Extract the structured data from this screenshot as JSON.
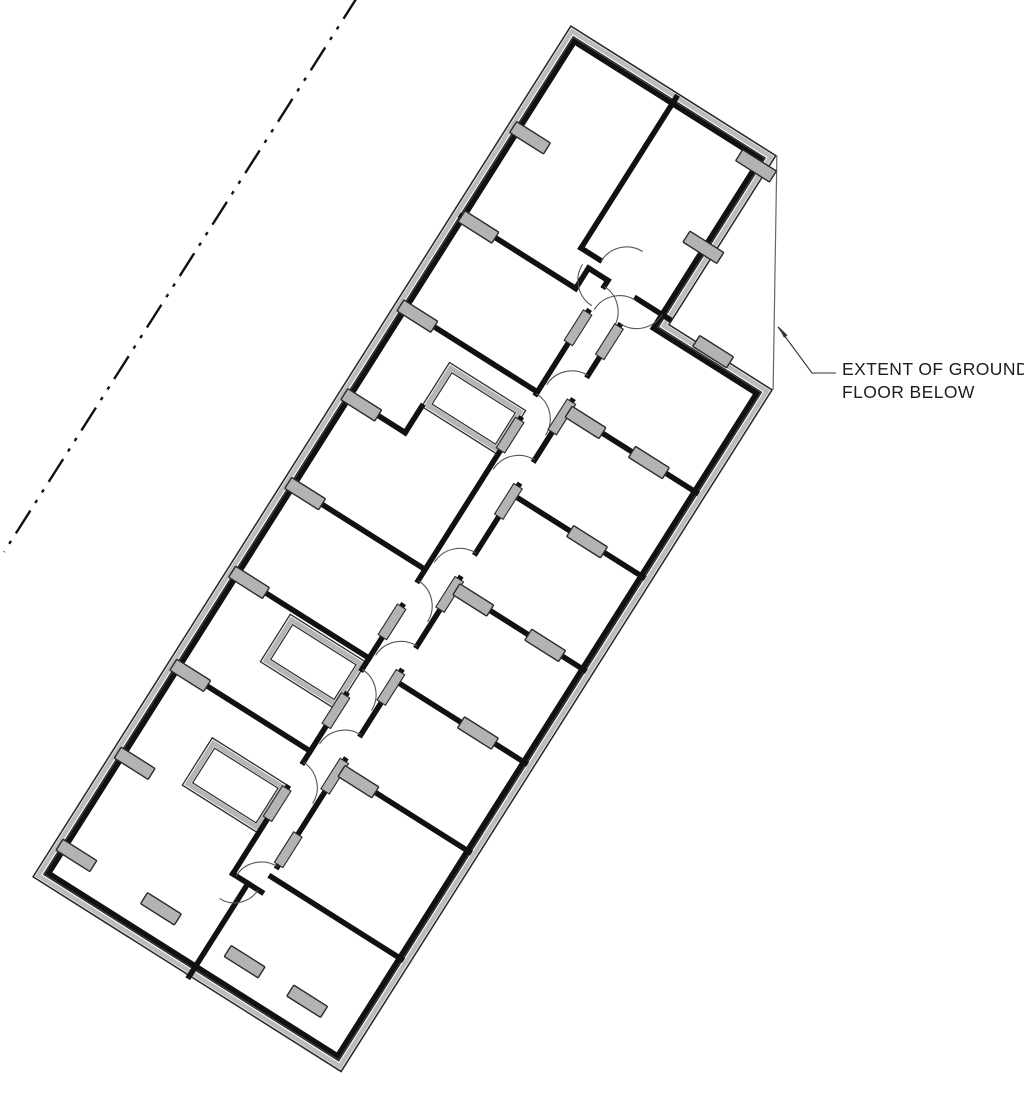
{
  "title": "first-floor-plan",
  "annotation": {
    "line1": "EXTENT OF GROUND",
    "line2": "FLOOR BELOW",
    "left": 842,
    "top": 358
  },
  "colors": {
    "wall": "#111111",
    "wall_thin": "#2b2b2b",
    "cavity_gray": "#bcbcbc",
    "column_fill": "#b3b3b3",
    "column_stroke": "#2a2a2a",
    "arc": "#555555",
    "extent_line": "#666666",
    "leader": "#333333",
    "boundary": "#111111",
    "background": "#ffffff"
  },
  "plan": {
    "origin": [
      32,
      877
    ],
    "angle_deg": -57.7,
    "outline": {
      "length": 1008,
      "width": 366,
      "notch_u": 808,
      "notch_v": 244
    },
    "outline_layers": [
      {
        "inset": 0.8,
        "color": "#2b2b2b",
        "w": 1.6,
        "fill": "#ffffff"
      },
      {
        "inset": 4.5,
        "color": "#bcbcbc",
        "w": 4.5,
        "fill": "none"
      },
      {
        "inset": 8.5,
        "color": "#2b2b2b",
        "w": 1.4,
        "fill": "none"
      },
      {
        "inset": 12.0,
        "color": "#111111",
        "w": 5.5,
        "fill": "none"
      }
    ],
    "extent_line": [
      1008,
      244,
      808,
      366
    ],
    "wall_stroke_w": 5.5,
    "walls": [
      [
        110,
        168,
        212,
        168
      ],
      [
        242,
        168,
        322,
        168
      ],
      [
        352,
        168,
        427,
        168
      ],
      [
        457,
        168,
        648,
        168
      ],
      [
        678,
        168,
        775,
        168
      ],
      [
        805,
        168,
        812,
        168
      ],
      [
        140,
        202,
        266,
        202
      ],
      [
        296,
        202,
        371,
        202
      ],
      [
        401,
        202,
        481,
        202
      ],
      [
        511,
        202,
        591,
        202
      ],
      [
        621,
        202,
        691,
        202
      ],
      [
        721,
        202,
        780,
        202
      ],
      [
        255,
        10,
        255,
        168
      ],
      [
        365,
        10,
        365,
        168
      ],
      [
        470,
        10,
        470,
        168
      ],
      [
        575,
        10,
        575,
        78
      ],
      [
        575,
        78,
        606,
        78
      ],
      [
        680,
        10,
        680,
        168
      ],
      [
        788,
        10,
        788,
        145
      ],
      [
        788,
        145,
        812,
        145
      ],
      [
        812,
        145,
        812,
        168
      ],
      [
        812,
        202,
        812,
        240
      ],
      [
        110,
        168,
        110,
        202
      ],
      [
        0,
        186,
        110,
        186
      ],
      [
        128,
        202,
        128,
        356
      ],
      [
        255,
        202,
        255,
        356
      ],
      [
        360,
        202,
        360,
        356
      ],
      [
        470,
        202,
        470,
        356
      ],
      [
        580,
        202,
        580,
        356
      ],
      [
        680,
        202,
        680,
        356
      ],
      [
        825,
        128,
        1003,
        128
      ],
      [
        825,
        128,
        825,
        150
      ]
    ],
    "arcs": [
      "M 242 168 A 30 30 0 0 1 212 198",
      "M 352 168 A 30 30 0 0 1 322 198",
      "M 457 168 A 30 30 0 0 1 427 198",
      "M 678 168 A 30 30 0 0 1 648 198",
      "M 805 168 A 30 30 0 0 1 775 198",
      "M 140 202 A 30 30 0 0 0 110 172",
      "M 296 202 A 30 30 0 0 0 266 172",
      "M 401 202 A 30 30 0 0 0 371 172",
      "M 511 202 A 30 30 0 0 0 481 172",
      "M 621 202 A 30 30 0 0 0 591 172",
      "M 721 202 A 30 30 0 0 0 691 172",
      "M 810 202 A 30 30 0 0 0 780 172",
      "M 110 198 A 28 28 0 0 1 82 170",
      "M 782 168 A 30 30 0 0 1 812 138",
      "M 782 202 A 30 30 0 0 0 812 232",
      "M 825 152 A 30 30 0 0 1 855 182"
    ],
    "shafts": [
      [
        158,
        78,
        56,
        90
      ],
      [
        304,
        78,
        56,
        90
      ],
      [
        606,
        78,
        52,
        90
      ]
    ],
    "columns": [
      [
        42,
        26
      ],
      [
        151,
        26
      ],
      [
        255,
        26
      ],
      [
        365,
        26
      ],
      [
        470,
        26
      ],
      [
        575,
        26
      ],
      [
        680,
        26
      ],
      [
        788,
        30
      ],
      [
        891,
        26
      ],
      [
        255,
        225
      ],
      [
        360,
        300
      ],
      [
        470,
        225
      ],
      [
        470,
        310
      ],
      [
        580,
        290
      ],
      [
        680,
        225
      ],
      [
        680,
        300
      ],
      [
        808,
        295
      ],
      [
        891,
        231
      ],
      [
        988,
        232
      ],
      [
        42,
        126
      ],
      [
        42,
        225
      ],
      [
        42,
        299
      ]
    ],
    "column_size": [
      13,
      40
    ],
    "thresholds": [
      [
        193,
        168
      ],
      [
        303,
        168
      ],
      [
        408,
        168
      ],
      [
        629,
        168
      ],
      [
        756,
        168
      ],
      [
        160,
        202
      ],
      [
        247,
        202
      ],
      [
        352,
        202
      ],
      [
        462,
        202
      ],
      [
        572,
        202
      ],
      [
        672,
        202
      ],
      [
        761,
        202
      ]
    ],
    "threshold_size": [
      36,
      10
    ],
    "boundary_line": {
      "pts": [
        358,
        -4,
        4,
        552
      ],
      "dash": "27 9 3.5 9 3.5 9",
      "w": 2.4
    },
    "leader": {
      "points": "836,373 812,373 778,327",
      "arrow": "778,326 787.5,335.2 784,337.8"
    }
  }
}
